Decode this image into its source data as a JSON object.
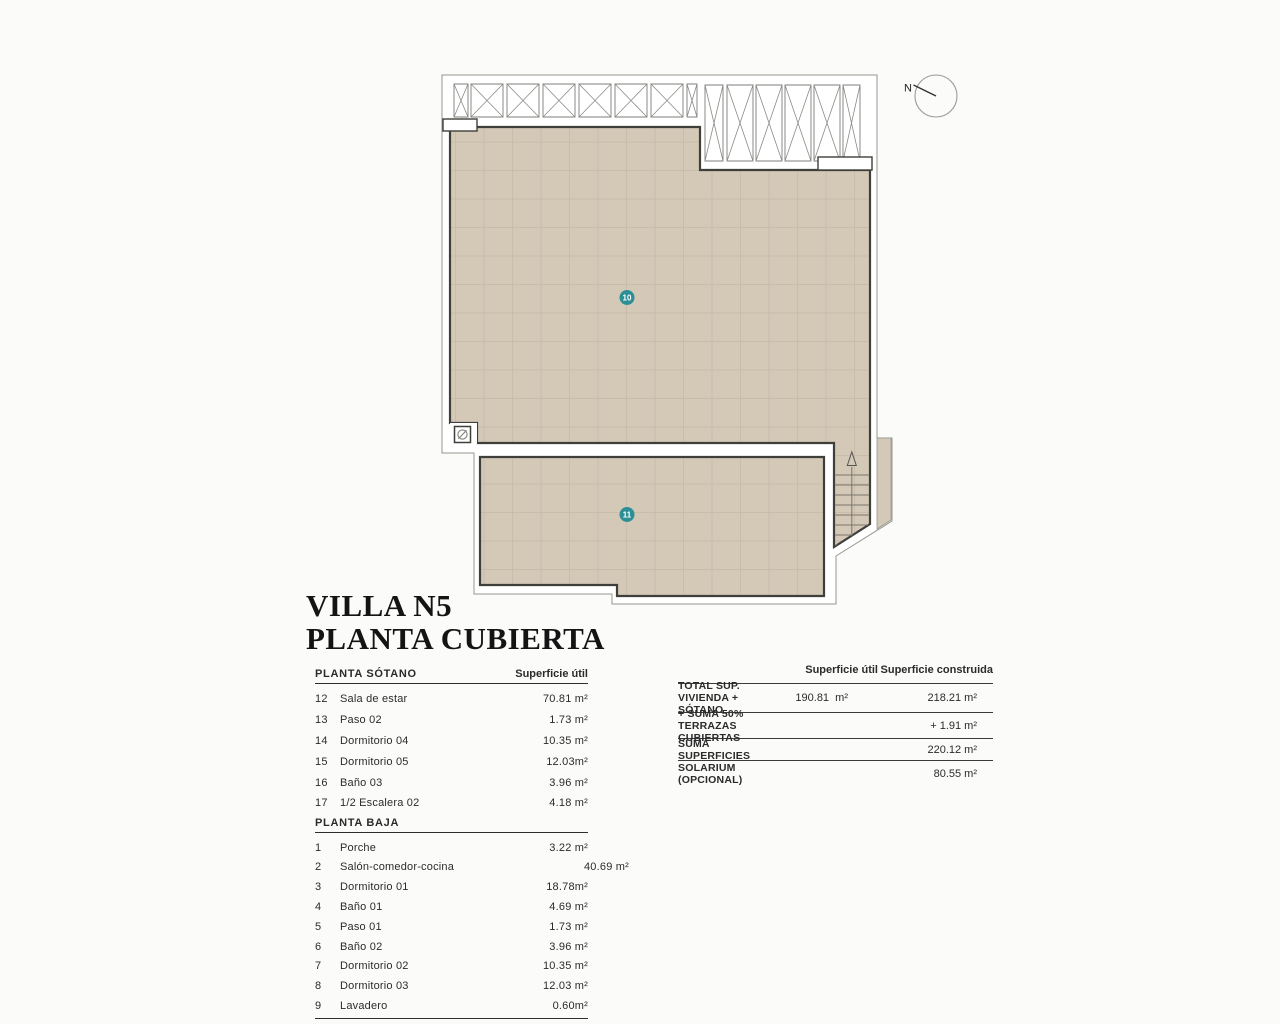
{
  "title": {
    "line1": "VILLA N5",
    "line2": "PLANTA CUBIERTA"
  },
  "compass": {
    "label": "N"
  },
  "plan": {
    "area_labels": [
      {
        "id": "10"
      },
      {
        "id": "11"
      }
    ],
    "icons": {
      "drain": "circle-slash-icon",
      "stair_direction": "up-arrow-icon"
    },
    "colors": {
      "roof_fill": "#d4c8b7",
      "roof_grid": "#c6b9a7",
      "wall_stroke": "#3e3e3a",
      "outline": "#96968f",
      "label_teal": "#2d8f96"
    }
  },
  "room_table": {
    "sections": [
      {
        "header": "PLANTA SÓTANO",
        "value_header": "Superficie útil",
        "rows": [
          {
            "num": "12",
            "name": "Sala de estar",
            "value": "70.81 m²"
          },
          {
            "num": "13",
            "name": "Paso 02",
            "value": "1.73 m²"
          },
          {
            "num": "14",
            "name": "Dormitorio 04",
            "value": "10.35 m²"
          },
          {
            "num": "15",
            "name": "Dormitorio 05",
            "value": "12.03m²"
          },
          {
            "num": "16",
            "name": "Baño 03",
            "value": "3.96 m²"
          },
          {
            "num": "17",
            "name": "1/2 Escalera 02",
            "value": "4.18 m²"
          }
        ]
      },
      {
        "header": "PLANTA BAJA",
        "rows": [
          {
            "num": "1",
            "name": "Porche",
            "value": "3.22 m²"
          },
          {
            "num": "2",
            "name": "Salón-comedor-cocina",
            "value": "40.69 m²"
          },
          {
            "num": "3",
            "name": "Dormitorio 01",
            "value": "18.78m²"
          },
          {
            "num": "4",
            "name": "Baño 01",
            "value": "4.69 m²"
          },
          {
            "num": "5",
            "name": "Paso 01",
            "value": "1.73 m²"
          },
          {
            "num": "6",
            "name": "Baño 02",
            "value": "3.96 m²"
          },
          {
            "num": "7",
            "name": "Dormitorio 02",
            "value": "10.35 m²"
          },
          {
            "num": "8",
            "name": "Dormitorio 03",
            "value": "12.03 m²"
          },
          {
            "num": "9",
            "name": "Lavadero",
            "value": "0.60m²"
          }
        ]
      }
    ]
  },
  "summary_table": {
    "headers": {
      "util": "Superficie útil",
      "construida": "Superficie construida"
    },
    "rows": [
      {
        "label": "TOTAL SUP. VIVIENDA + SÓTANO",
        "util": "190.81  m²",
        "construida": "218.21 m²"
      },
      {
        "label": "+ SUMA 50% TERRAZAS CUBIERTAS",
        "util": "",
        "construida": "+ 1.91 m²"
      },
      {
        "label": "SUMA SUPERFICIES",
        "util": "",
        "construida": "220.12 m²"
      },
      {
        "label": "SOLARIUM (OPCIONAL)",
        "util": "",
        "construida": "80.55 m²"
      }
    ]
  }
}
